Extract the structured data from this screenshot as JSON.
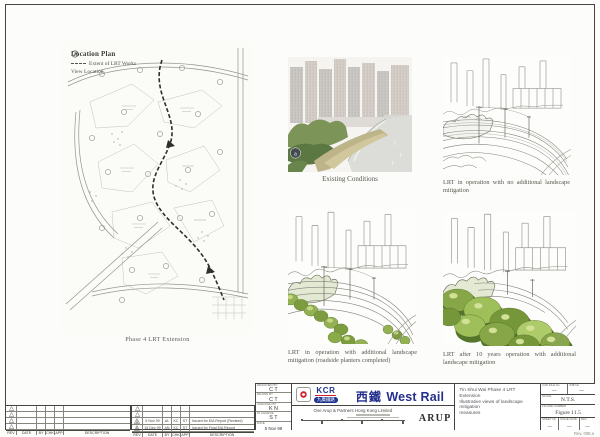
{
  "location_plan": {
    "title": "Location Plan",
    "legend": [
      {
        "label": "Extent of LRT Works"
      },
      {
        "label": "View Location"
      }
    ],
    "caption": "Phase 4 LRT Extension"
  },
  "views": {
    "existing": {
      "marker": "a",
      "caption": "Existing Conditions"
    },
    "no_mitigation": {
      "caption": "LRT in operation with no additional landscape mitigation"
    },
    "planters": {
      "caption": "LRT in operation with additional landscape mitigation (roadside planters completed)"
    },
    "ten_years": {
      "caption": "LRT after 10 years operation with additional landscape mitigation"
    }
  },
  "title_block": {
    "credits": [
      {
        "label": "DESIGNED BY",
        "value": "C T"
      },
      {
        "label": "DRAWN BY",
        "value": "C T"
      },
      {
        "label": "CHECKED BY",
        "value": "K N"
      },
      {
        "label": "IN CHARGE",
        "value": "S T"
      },
      {
        "label": "DATE",
        "value": "5 Nov 99"
      }
    ],
    "client": {
      "kcr": "KCR",
      "kcr_chinese": "九廣鐵路",
      "line_chinese": "西鐵",
      "line_english": "West Rail"
    },
    "consultant": {
      "name": "Ove Arup & Partners Hong Kong Limited",
      "brand": "ARUP"
    },
    "project_title": [
      "Tin Shui Wai Phase 4 LRT Extension",
      "Illustrative views of landscape mitigation",
      "measures"
    ],
    "refs": {
      "cad_label": "CAD FILE No",
      "cad_value": "—",
      "job_label": "JOB No",
      "job_value": "—",
      "scale_label": "SCALE",
      "scale_value": "N.T.S.",
      "figure_label": "FIGURE NUMBER",
      "figure_value": "Figure 11.5",
      "sheet_label": "SHEET No",
      "sheet_value": "—",
      "issue_label": "ISSUE DATE",
      "issue_value": "—",
      "rev_label": "REV",
      "rev_value": "—"
    },
    "stamp": "Rev. 008.a"
  },
  "revisions": {
    "headers": [
      "REV",
      "DATE",
      "BY",
      "CHK",
      "APP",
      "DESCRIPTION"
    ],
    "rows": [
      {
        "rev": "A",
        "date": "5 Nov 99",
        "by": "AL",
        "chk": "KC",
        "app": "ST",
        "description": "Issued for EIA Report (Revised)"
      },
      {
        "rev": "B",
        "date": "15 Dec 99",
        "by": "AN",
        "chk": "KC",
        "app": "ST",
        "description": "Issued for Final EIA Report"
      }
    ]
  }
}
